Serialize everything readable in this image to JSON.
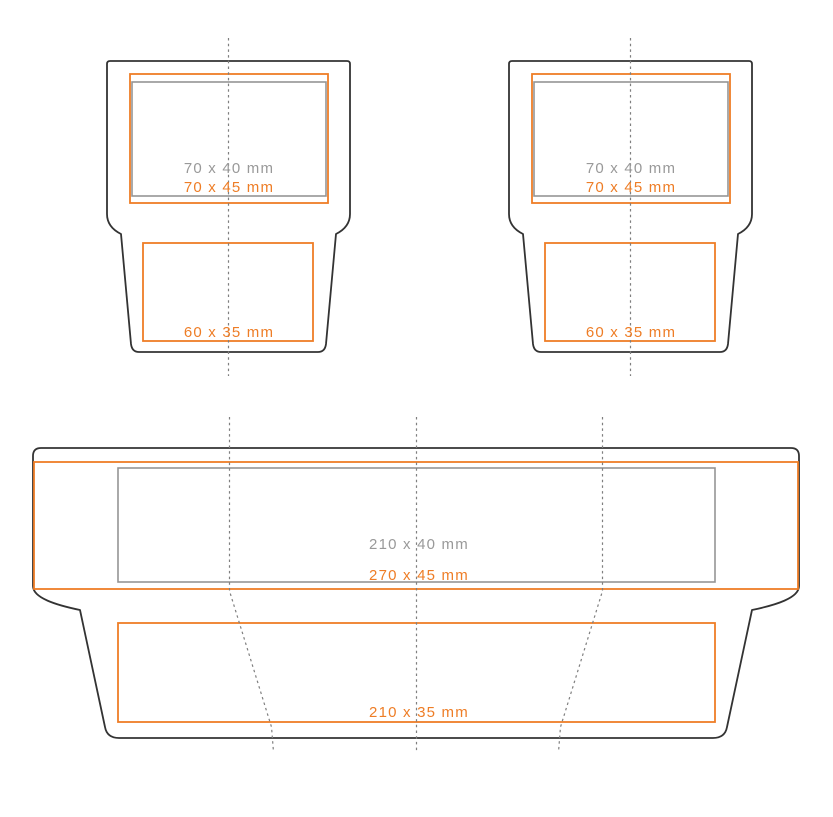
{
  "templates": {
    "small_left": {
      "print_area": "70 x 40 mm",
      "bleed_area": "70 x 45 mm",
      "bottom_area": "60 x 35 mm"
    },
    "small_right": {
      "print_area": "70 x 40 mm",
      "bleed_area": "70 x 45 mm",
      "bottom_area": "60 x 35 mm"
    },
    "large": {
      "print_area": "210 x 40 mm",
      "bleed_area": "270 x 45 mm",
      "bottom_area": "210 x 35 mm"
    }
  },
  "colors": {
    "orange": "#EE7D26",
    "gray_text": "#999999",
    "gray_box": "#949494",
    "outline": "#333333",
    "dash": "#7F7F7F",
    "background": "#FFFFFF"
  }
}
